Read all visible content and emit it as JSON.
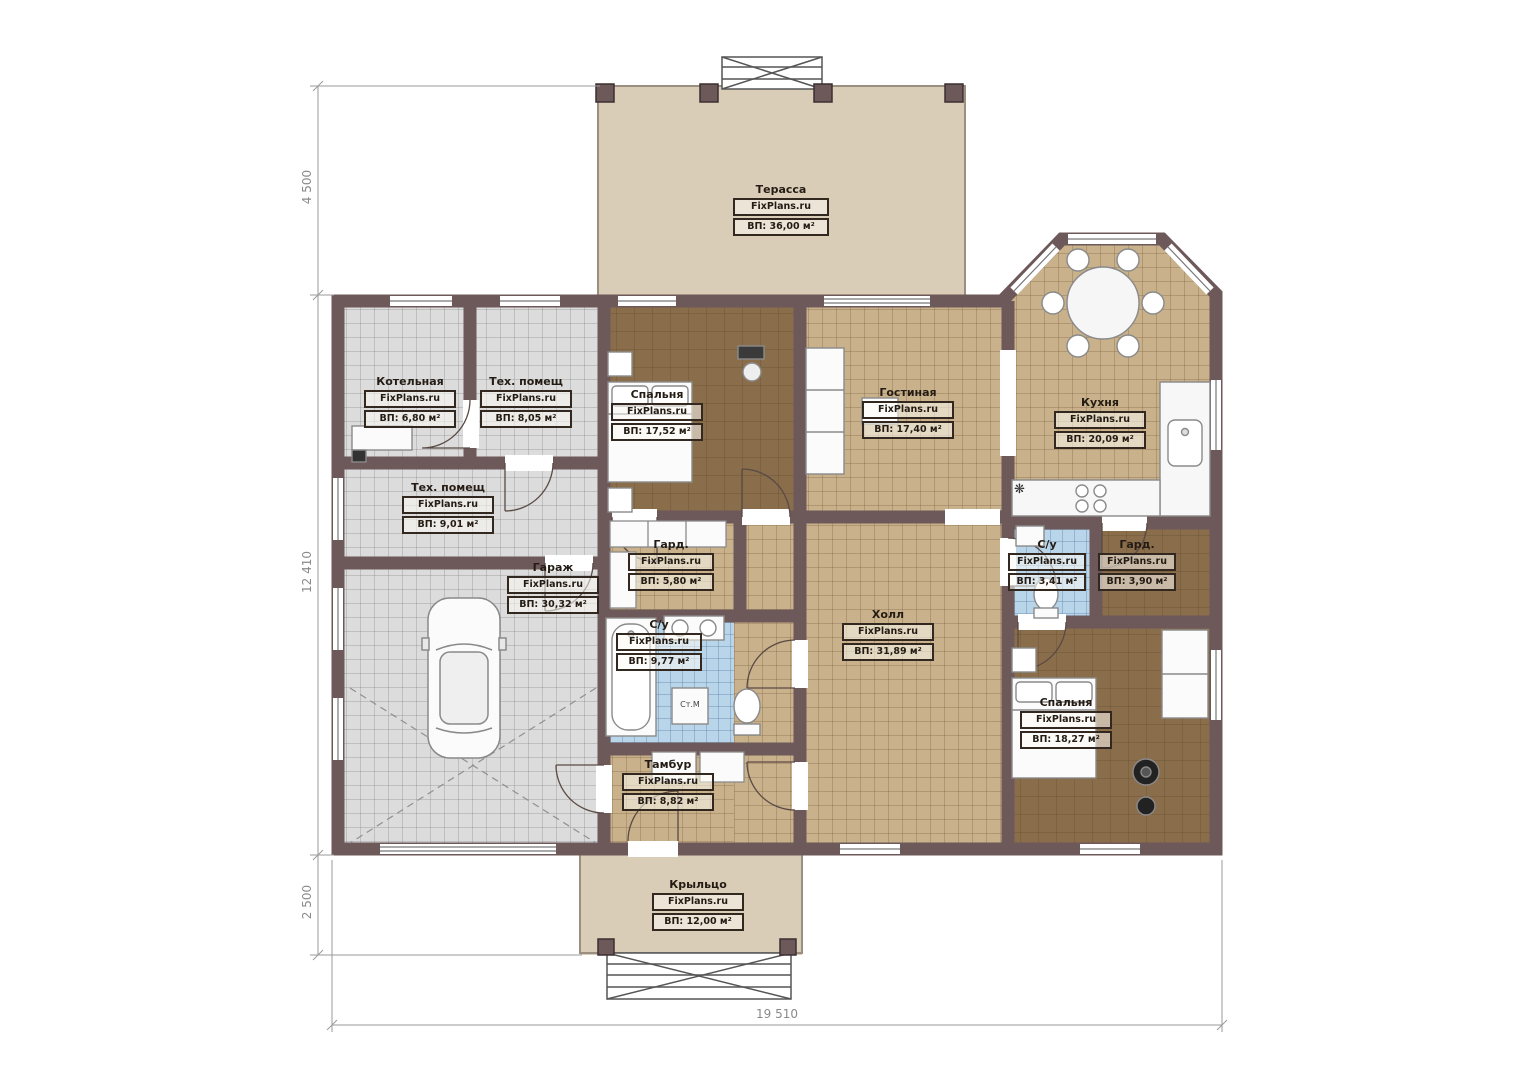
{
  "plan": {
    "brand": "FixPlans.ru",
    "rooms": [
      {
        "name": "Терасса",
        "area": "ВП: 36,00 м²"
      },
      {
        "name": "Котельная",
        "area": "ВП: 6,80 м²"
      },
      {
        "name": "Тех. помещ",
        "area": "ВП: 8,05 м²"
      },
      {
        "name": "Тех. помещ",
        "area": "ВП: 9,01 м²"
      },
      {
        "name": "Гараж",
        "area": "ВП: 30,32 м²"
      },
      {
        "name": "Спальня",
        "area": "ВП: 17,52 м²"
      },
      {
        "name": "Гостиная",
        "area": "ВП: 17,40 м²"
      },
      {
        "name": "Кухня",
        "area": "ВП: 20,09 м²"
      },
      {
        "name": "Гард.",
        "area": "ВП: 5,80 м²"
      },
      {
        "name": "С/у",
        "area": "ВП: 9,77 м²"
      },
      {
        "name": "Холл",
        "area": "ВП: 31,89 м²"
      },
      {
        "name": "С/у",
        "area": "ВП: 3,41 м²"
      },
      {
        "name": "Гард.",
        "area": "ВП: 3,90 м²"
      },
      {
        "name": "Спальня",
        "area": "ВП: 18,27 м²"
      },
      {
        "name": "Тамбур",
        "area": "ВП: 8,82 м²"
      },
      {
        "name": "Крыльцо",
        "area": "ВП: 12,00 м²"
      }
    ],
    "appliances": {
      "washing_machine": "Ст.М"
    },
    "icons": {
      "fridge_snowflake": "❋"
    },
    "dimensions": {
      "terrace_depth": "4 500",
      "house_height": "12 410",
      "porch_depth": "2 500",
      "total_width": "19 510"
    },
    "colors": {
      "wall": "#6d585a",
      "terrace": "#dacdb7",
      "tile_gray": "#dcdcdc",
      "tile_tan": "#c8b18b",
      "tile_blue": "#b9d5ea",
      "floor_brown": "#8a6d4b"
    }
  }
}
